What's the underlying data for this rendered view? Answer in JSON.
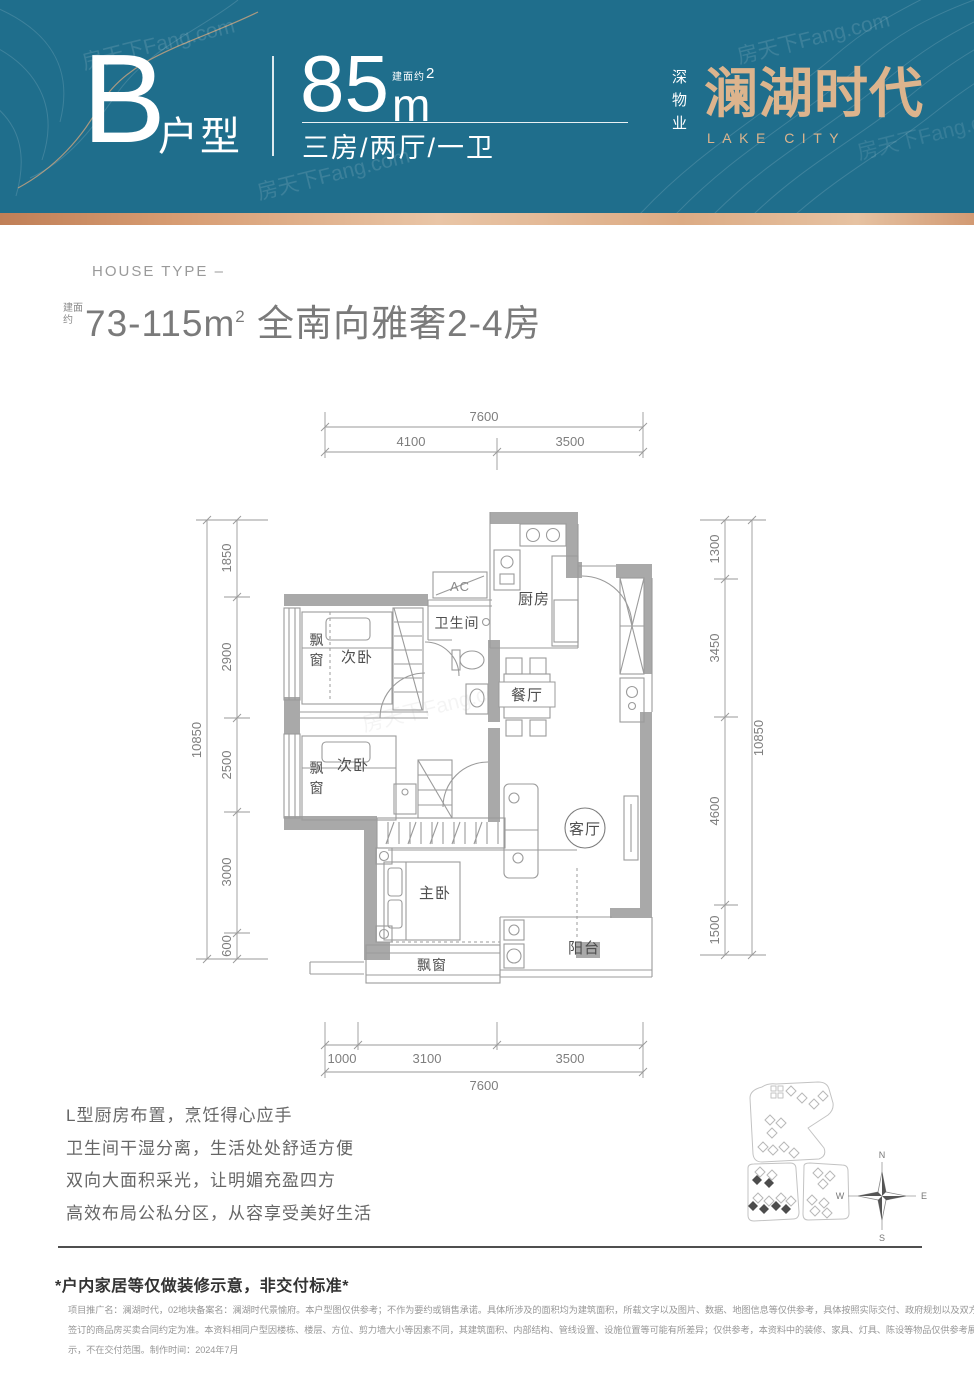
{
  "header": {
    "type_letter": "B",
    "type_label": "户型",
    "area_prefix": "建面约",
    "area_value": "85",
    "area_unit": "m",
    "area_exp": "2",
    "layout_text": "三房/两厅/一卫",
    "brand_prefix": "深物业",
    "brand_name": "澜湖时代",
    "brand_en": "LAKE CITY"
  },
  "watermark_text": "房天下Fang.com",
  "intro": {
    "eyebrow": "HOUSE TYPE –",
    "area_prefix": "建面约",
    "area_range": "73-115m",
    "area_exp": "2",
    "title_rest": " 全南向雅奢2-4房"
  },
  "floorplan": {
    "rooms": {
      "bedroom_a": "次卧",
      "bedroom_b": "次卧",
      "master": "主卧",
      "living": "客厅",
      "dining": "餐厅",
      "kitchen": "厨房",
      "bath": "卫生间",
      "balcony": "阳台",
      "bay_a": "飘窗",
      "bay_b": "飘窗",
      "bay_c": "飘窗",
      "ac": "AC"
    },
    "dims": {
      "top_total": "7600",
      "top_seg_1": "4100",
      "top_seg_2": "3500",
      "bottom_seg_1": "1000",
      "bottom_seg_2": "3100",
      "bottom_seg_3": "3500",
      "bottom_total": "7600",
      "left_total": "10850",
      "left_seg_1": "1850",
      "left_seg_2": "2900",
      "left_seg_3": "2500",
      "left_seg_4": "3000",
      "left_seg_5": "600",
      "right_total": "10850",
      "right_seg_1": "1300",
      "right_seg_2": "3450",
      "right_seg_3": "4600",
      "right_seg_4": "1500"
    },
    "compass": {
      "n": "N",
      "e": "E",
      "s": "S",
      "w": "W"
    }
  },
  "features": [
    "L型厨房布置，烹饪得心应手",
    "卫生间干湿分离，生活处处舒适方便",
    "双向大面积采光，让明媚充盈四方",
    "高效布局公私分区，从容享受美好生活"
  ],
  "footer": {
    "note": "*户内家居等仅做装修示意，非交付标准*",
    "disclaimer_1": "项目推广名：澜湖时代，02地块备案名：澜湖时代景愉府。本户型图仅供参考；不作为要约或销售承诺。具体所涉及的面积均为建筑面积，所载文字以及图片、数据、地图信息等仅供参考，具体按照实际交付、政府规划以及双方",
    "disclaimer_2": "签订的商品房买卖合同约定为准。本资料相同户型因楼栋、楼层、方位、剪力墙大小等因素不同，其建筑面积、内部结构、管线设置、设施位置等可能有所差异；仅供参考，本资料中的装修、家具、灯具、陈设等物品仅供参考展",
    "disclaimer_3": "示，不在交付范围。制作时间：2024年7月"
  },
  "colors": {
    "teal": "#1f6e8c",
    "copper": "#c98a5e",
    "gold": "#dcb48d",
    "wall_gray": "#a9a9a9"
  }
}
